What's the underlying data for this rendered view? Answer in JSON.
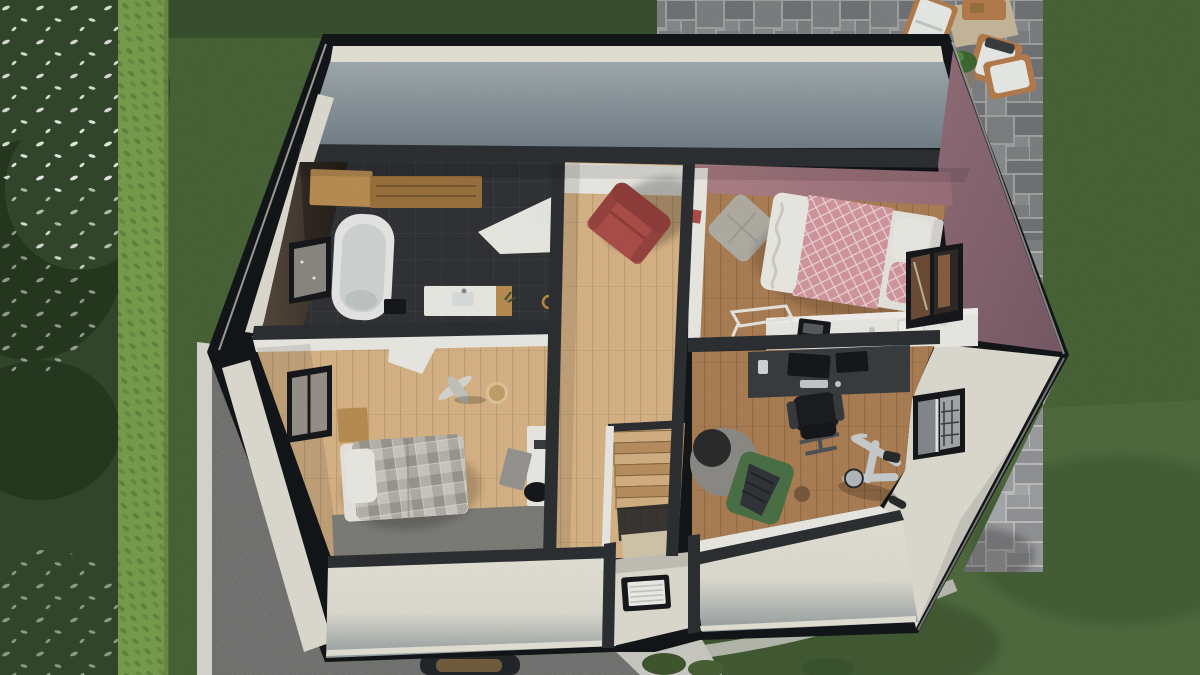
{
  "app": {
    "type": "3d-floorplan-render",
    "view": "top-down dollhouse cutaway of upper floor",
    "visible_text": "none"
  },
  "scene": {
    "rooms": [
      {
        "name": "bathroom",
        "position": "top-left",
        "floor": "dark charcoal tile",
        "items": [
          "wall-shelf-wood",
          "bathtub",
          "vanity-sink",
          "toilet",
          "mirror-window",
          "stool",
          "towel-ring",
          "sloped-ceiling-panel"
        ]
      },
      {
        "name": "hallway-landing",
        "position": "center",
        "floor": "light oak",
        "items": [
          "red-armchair",
          "staircase-down",
          "stair-railing",
          "entry-doormat"
        ]
      },
      {
        "name": "bedroom-pink",
        "position": "top-right",
        "walls": "mauve-pink",
        "floor": "medium oak",
        "items": [
          "double-bed-pink-quilt",
          "floor-cushion-gray",
          "white-desk",
          "laptop",
          "trestle-table",
          "poster",
          "window-east"
        ]
      },
      {
        "name": "office-gym",
        "position": "bottom-right",
        "floor": "medium oak",
        "items": [
          "gaming-desk",
          "dual-monitors",
          "gaming-chair-black",
          "pouf-gray",
          "lounge-chair-green",
          "blanket-dark",
          "exercise-bike",
          "dumbbell",
          "window-east"
        ]
      },
      {
        "name": "bedroom-gray",
        "position": "bottom-left",
        "floor": "light oak",
        "items": [
          "single-bed-plaid",
          "nightstand-wood",
          "wardrobe-white",
          "area-rug-gray",
          "white-desk",
          "leaning-board",
          "desk-chair-dark",
          "toy-plane",
          "ball-lamp",
          "window-west"
        ]
      }
    ],
    "exterior": {
      "areas": [
        "lawn",
        "tree-canopy-west",
        "flowering-trees",
        "hedge-row",
        "sidewalk-strip",
        "asphalt-driveway",
        "paver-patio-northeast",
        "garden-path",
        "shrubs"
      ],
      "patio_furniture": [
        "outdoor-lounger-white",
        "outdoor-rug-tan",
        "wood-coffee-table",
        "wood-armchair-1",
        "wood-armchair-2",
        "potted-plant",
        "serving-tray-dark"
      ],
      "vehicle": "car-roof-at-bottom-edge"
    }
  },
  "colors": {
    "grassBase": "#4b6639",
    "grassLight": "#5d7a4a",
    "grassDark": "#3a5230",
    "forest": "#33492c",
    "forestDark": "#263a20",
    "blossom": "#f2f3ee",
    "hedge": "#7ca04f",
    "hedgeDark": "#5d8140",
    "sidewalk": "#dcdbd4",
    "asphalt": "#949492",
    "paverJoint": "#c6c7c5",
    "paverA": "#9a9da0",
    "paverB": "#8b8e92",
    "paverC": "#a8abae",
    "outline": "#14171a",
    "wallCut": "#2e3134",
    "fasciaCream": "#e9e6da",
    "extWall": "#e3e1d6",
    "extWallShade": "#97a0a1",
    "topWallLight": "#a3adb2",
    "topWallDark": "#75828a",
    "mauve": "#8d6a75",
    "mauveDark": "#7a5c68",
    "pinkWall": "#b2838b",
    "oakLight": "#ddb88a",
    "oakMid": "#b08257",
    "charcoalFloor": "#323437",
    "tileLine": "#47494c",
    "brownTile": "#4e4237",
    "brownTileDark": "#352d25",
    "white": "#f0efe9",
    "porcelain": "#ecedeb",
    "porcelainShade": "#d5d9d8",
    "woodShelf": "#bd9155",
    "woodShelfDark": "#9d7440",
    "chairRed": "#b0504b",
    "chairRedDark": "#93403c",
    "bedPink": "#d89aa2",
    "sheetWhite": "#eceae4",
    "plaidBase": "#cfccc5",
    "plaidGray": "#a19d95",
    "plaidDark": "#8b8780",
    "rugGray": "#807f7a",
    "deskDark": "#3b3e42",
    "monitor": "#17191c",
    "chairBlack": "#1c1e21",
    "pouf": "#908e89",
    "poufTop": "#2d2d2d",
    "loungeGreen": "#4d7348",
    "blanketGray": "#33363a",
    "bike": "#cdd1d3",
    "bikeDark": "#2a2c2e",
    "matFrame": "#17191c",
    "matWhite": "#f2f2ee",
    "stairWood": "#d9b586",
    "stairWoodDark": "#bc9261",
    "entryFloor": "#e3e0d4",
    "glassGray": "#878c90",
    "glassDark": "#3c3f41",
    "windowWoodReflect": "#6e4f38",
    "carBody": "#24282b",
    "carTan": "#75603f",
    "pathLight": "#cfcec7",
    "rugTan": "#cbbc9e",
    "patioWood": "#b97f4e",
    "cushionWhite": "#eef0ee",
    "plantGreen": "#3f6b33",
    "potGray": "#8a8172"
  }
}
